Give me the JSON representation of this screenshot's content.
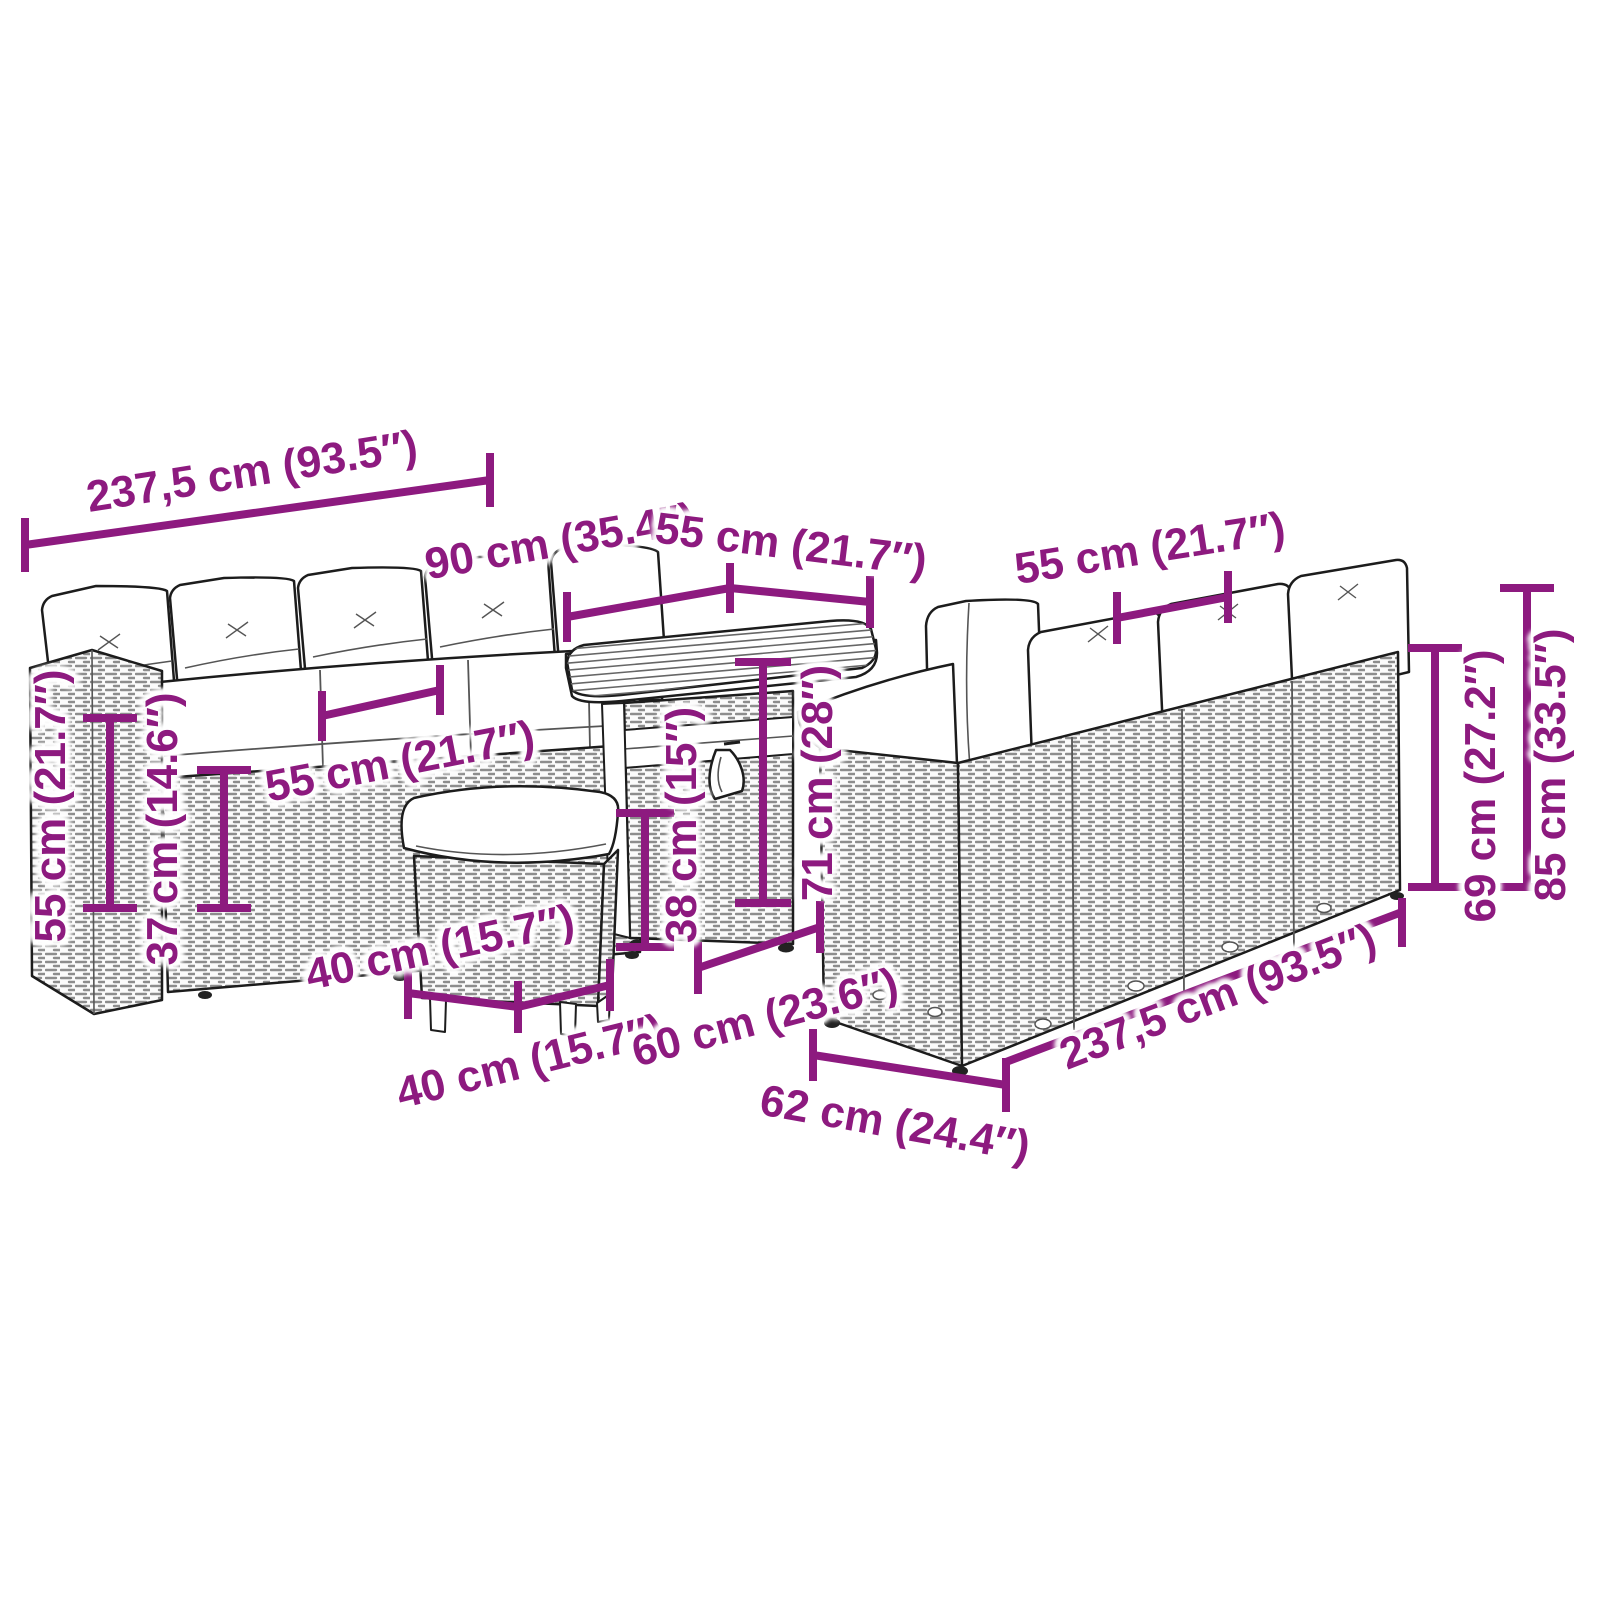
{
  "accent_color": "#8d1a7f",
  "dimensions": {
    "sofa_left_top_width": "237,5 cm (93.5″)",
    "table_length": "90 cm (35.4″)",
    "table_depth": "55 cm (21.7″)",
    "right_sofa_seat_width": "55 cm (21.7″)",
    "armrest_height": "55 cm (21.7″)",
    "seat_height": "37 cm (14.6″)",
    "seat_width": "55 cm (21.7″)",
    "stool_width": "40 cm (15.7″)",
    "stool_depth": "40 cm (15.7″)",
    "stool_height": "38 cm (15″)",
    "table_height": "71 cm (28″)",
    "table_base_width": "60 cm (23.6″)",
    "sofa_depth": "62 cm (24.4″)",
    "right_sofa_width": "237,5 cm (93.5″)",
    "back_height": "69 cm (27.2″)",
    "total_height": "85 cm (33.5″)"
  }
}
